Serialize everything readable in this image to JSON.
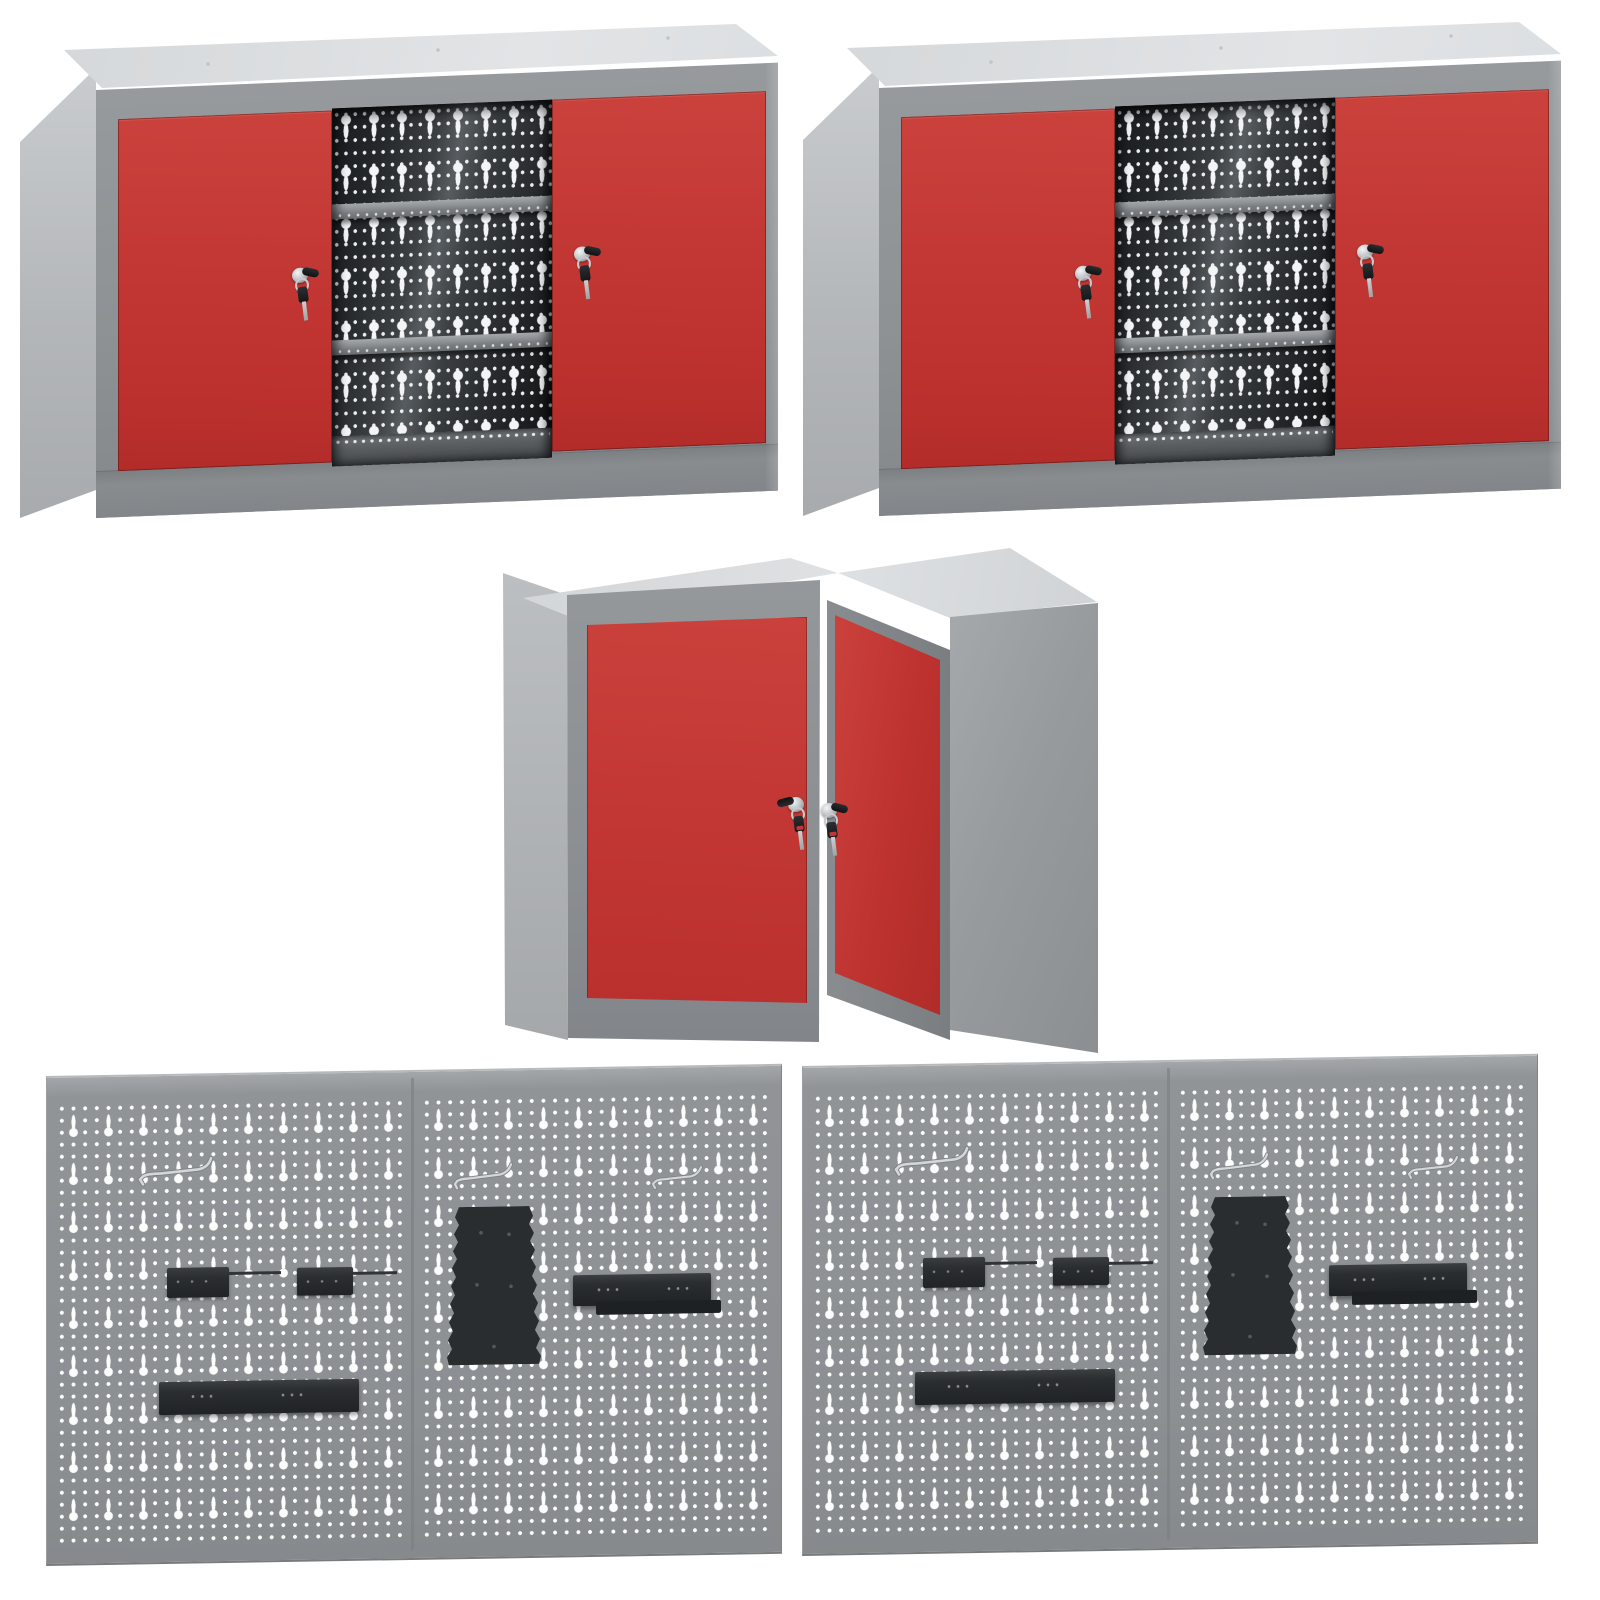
{
  "scene": {
    "type": "product-collage",
    "background_color": "#ffffff",
    "item_count": 5,
    "description": "Five workshop storage products: two wall cabinets with red sliding doors, one corner wall cabinet with red doors, two grey perforated tool panels with black holders"
  },
  "products": {
    "cabinet_a": {
      "title": "Metal wall cabinet with two red sliding doors, perforated back wall, two shelves and keys in both locks",
      "doors": 2,
      "locks": 2,
      "keys": 2,
      "shelves": 2
    },
    "cabinet_b": {
      "title": "Metal wall cabinet with two red sliding doors, perforated back wall, two shelves and keys in both locks",
      "doors": 2,
      "locks": 2,
      "keys": 2,
      "shelves": 2
    },
    "corner_cabinet": {
      "title": "Metal corner wall cabinet with two red doors and keys in both locks",
      "doors": 2,
      "locks": 2,
      "keys": 2
    },
    "panel_a": {
      "title": "Grey perforated tool wall panel with black holders, rails and hooks",
      "hooks": 3,
      "small_brackets": 2,
      "rails": 2,
      "tapered_holders": 1
    },
    "panel_b": {
      "title": "Grey perforated tool wall panel with black holders, rails and hooks",
      "hooks": 3,
      "small_brackets": 2,
      "rails": 2,
      "tapered_holders": 1
    }
  },
  "colors": {
    "door_red": "#c23733",
    "frame_grey": "#8f9396",
    "side_grey": "#b4b7ba",
    "top_grey": "#dcdee0",
    "interior_dark": "#2f3336",
    "panel_grey": "#8e9295",
    "holder_black": "#2b2e30",
    "hole_white": "#fbfcfc",
    "chrome": "#d8dbdd",
    "key_black": "#17191b"
  }
}
